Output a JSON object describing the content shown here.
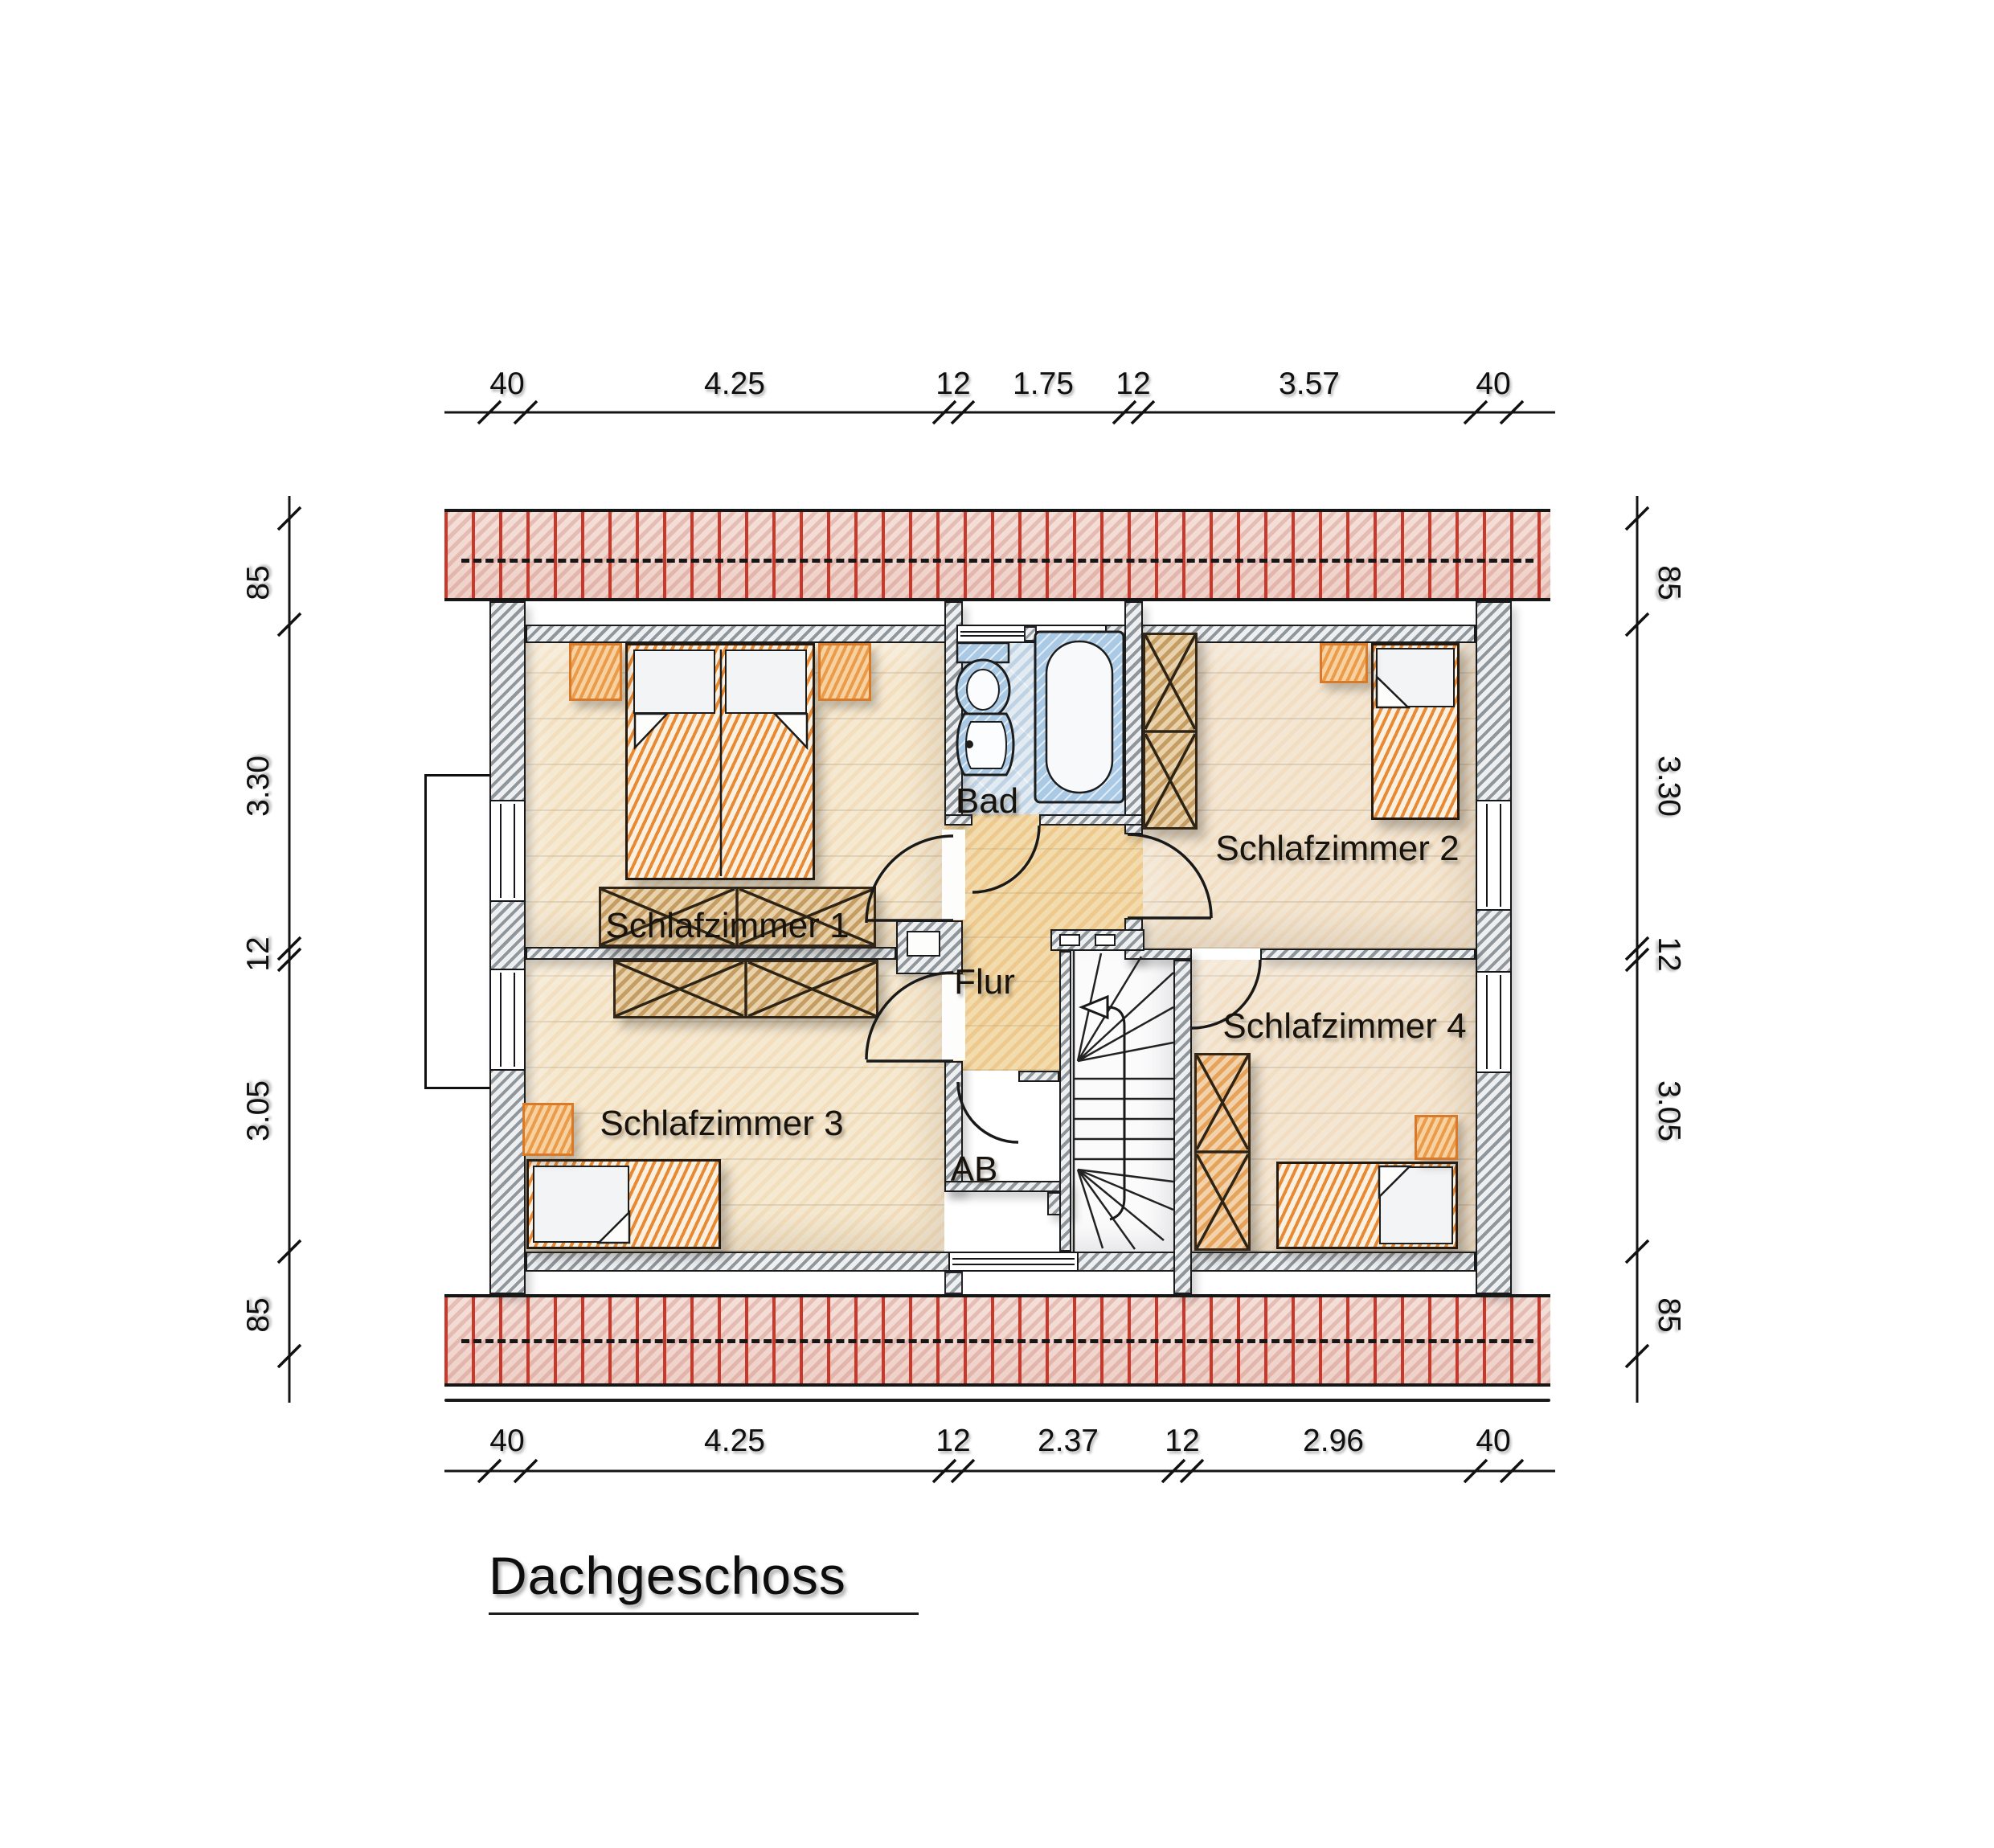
{
  "floor_plan": {
    "title": "Dachgeschoss",
    "rooms": {
      "schlafzimmer1": {
        "label": "Schlafzimmer 1"
      },
      "schlafzimmer2": {
        "label": "Schlafzimmer 2"
      },
      "schlafzimmer3": {
        "label": "Schlafzimmer 3"
      },
      "schlafzimmer4": {
        "label": "Schlafzimmer 4"
      },
      "bad": {
        "label": "Bad"
      },
      "flur": {
        "label": "Flur"
      },
      "ab": {
        "label": "AB"
      }
    },
    "dimensions": {
      "top": [
        "40",
        "4.25",
        "12",
        "1.75",
        "12",
        "3.57",
        "40"
      ],
      "bottom": [
        "40",
        "4.25",
        "12",
        "2.37",
        "12",
        "2.96",
        "40"
      ],
      "left": [
        "85",
        "3.30",
        "12",
        "3.05",
        "85"
      ],
      "right": [
        "85",
        "3.30",
        "12",
        "3.05",
        "85"
      ]
    },
    "colors": {
      "roof_batten_red": "#c8392b",
      "wall_gray": "#8f969c",
      "furniture_orange": "#e88a33",
      "wardrobe_tan": "#c89a5a",
      "bath_blue": "#a9c9e4",
      "floor_cream": "#f5e9d2",
      "flur_tint": "#f2dcae",
      "bad_floor_blue": "#e2ebf2"
    }
  }
}
